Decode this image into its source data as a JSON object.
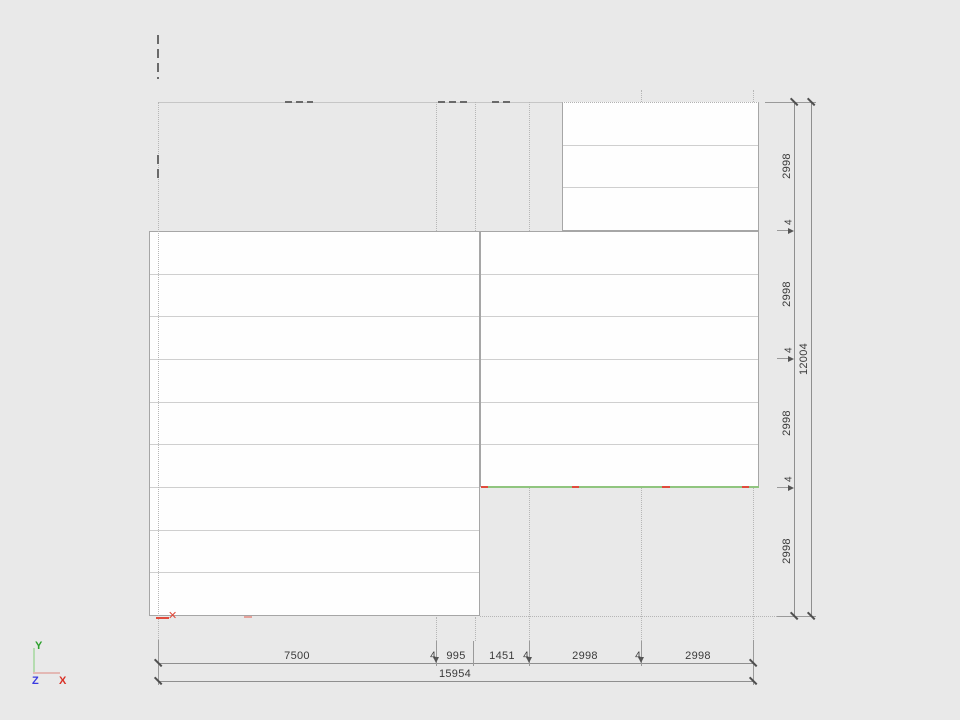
{
  "drawing": {
    "type": "cad-panel-layout-plan",
    "blocks": [
      {
        "id": "top-right",
        "rows": 3
      },
      {
        "id": "left",
        "rows": 9
      },
      {
        "id": "middle-right",
        "rows": 6
      }
    ],
    "marks": {
      "x_glyph": "✕"
    }
  },
  "dimensions": {
    "bottom": {
      "segments": [
        "7500",
        "4",
        "995",
        "1451",
        "4",
        "2998",
        "4",
        "2998"
      ],
      "total": "15954"
    },
    "right": {
      "segments": [
        "2998",
        "4",
        "2998",
        "4",
        "2998",
        "4",
        "2998"
      ],
      "total": "12004"
    }
  },
  "ucs": {
    "x_label": "X",
    "y_label": "Y",
    "z_label": "Z"
  },
  "colors": {
    "bg": "#e9e9e9",
    "green": "#90c57f",
    "red": "#e14b3c",
    "ucs-y": "#2ca02c",
    "ucs-x": "#d93025",
    "ucs-z": "#3a3ae0",
    "ucs-y-line": "#b5dcb0",
    "ucs-x-line": "#e3b8b4"
  }
}
